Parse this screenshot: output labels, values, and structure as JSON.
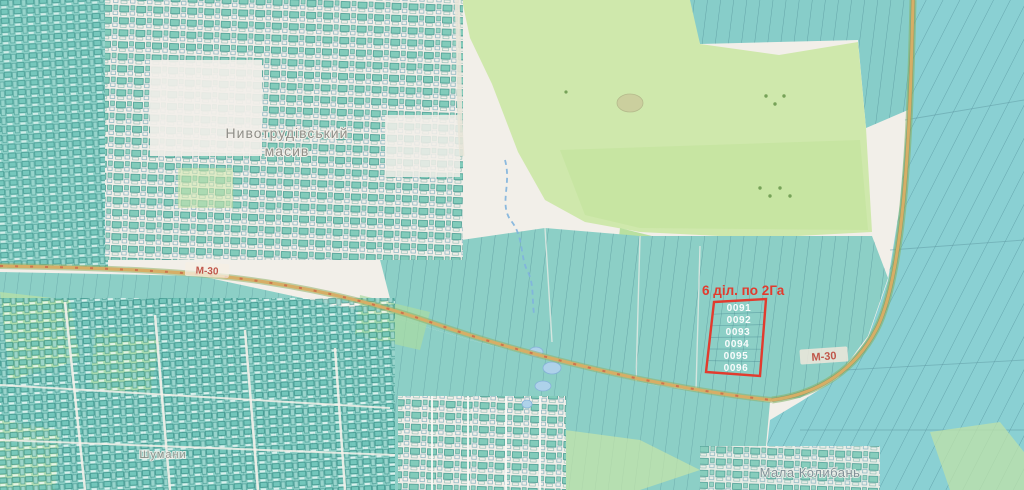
{
  "map": {
    "places": {
      "massif_line1": "Нивотрудівський",
      "massif_line2": "масив",
      "village_sw": "Шумани",
      "village_se": "Мала Колибань"
    },
    "roads": {
      "left_label": "М-30",
      "right_label": "М-30"
    },
    "annotation": {
      "title": "6 діл. по 2Га",
      "parcels": [
        "0091",
        "0092",
        "0093",
        "0094",
        "0095",
        "0096"
      ],
      "color": "#e23b2e"
    },
    "palette": {
      "background": "#f2efe9",
      "parcel_teal": "#8ccfc6",
      "parcel_teal_cool": "#8ad0d3",
      "parcel_outline": "#35707e",
      "field_green": "#cfe8ac",
      "village_building": "#7cc9b7",
      "road_fill": "#d6ae66",
      "road_edge_green": "#8fb06a",
      "water": "#aed2ea",
      "annotation_red": "#e23b2e",
      "label_gray": "#8f8f89"
    }
  }
}
